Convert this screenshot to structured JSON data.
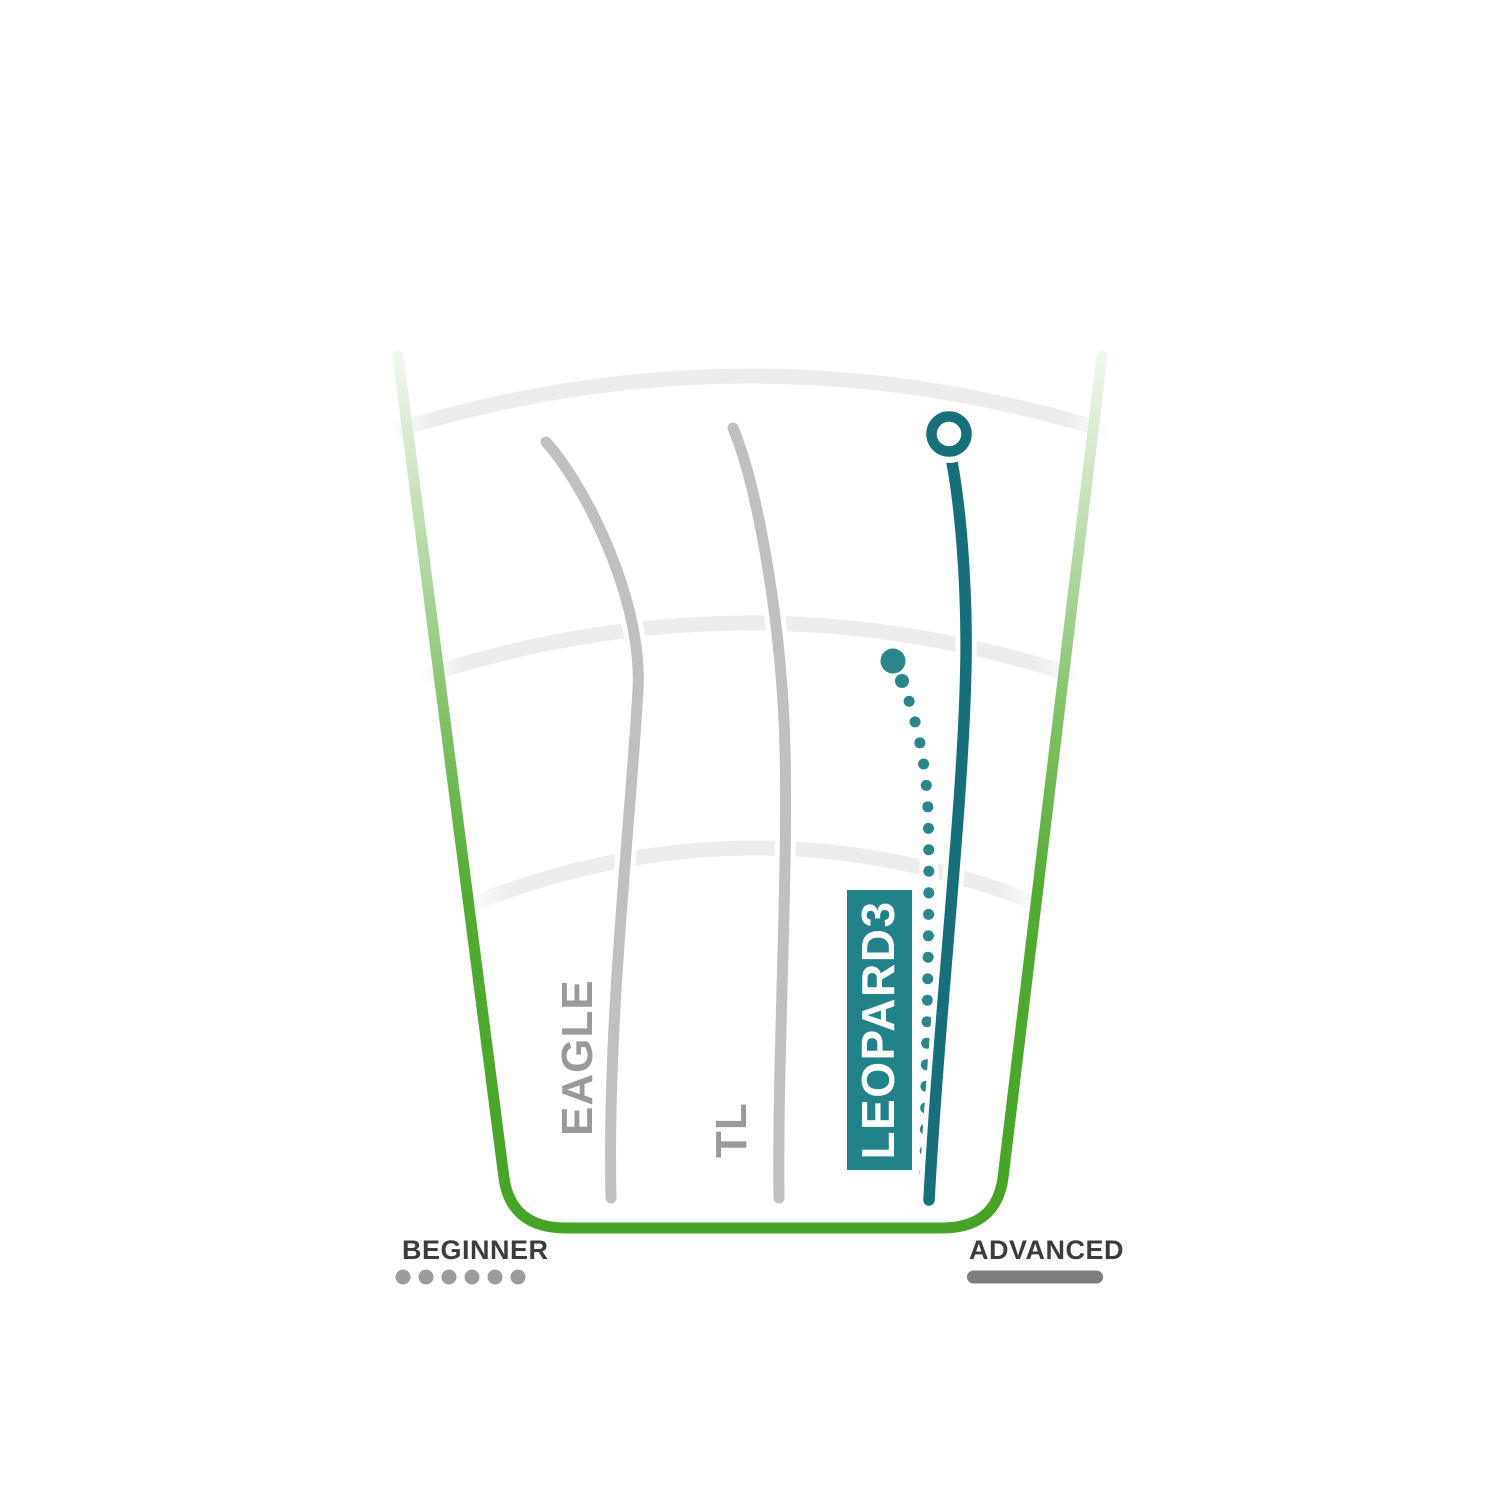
{
  "labels": {
    "beginner": "BEGINNER",
    "advanced": "ADVANCED"
  },
  "discs": {
    "eagle": "EAGLE",
    "tl": "TL",
    "leopard3": "LEOPARD3"
  },
  "colors": {
    "green": "#45a326",
    "green_mid": "#84c46a",
    "green_pale": "#cbe3c0",
    "green_faint": "#f2f6f0",
    "arc_gray": "#ededed",
    "gray_line": "#c0c0c0",
    "gray_text": "#9a9a9a",
    "teal_line": "#166f7a",
    "teal_box": "#21828a",
    "teal_dot": "#2b868c",
    "marker_fill": "#ffffff",
    "label_text_on_teal": "#ffffff",
    "legend_text": "#3c3c3c",
    "legend_dots": "#9c9c9c",
    "legend_bar": "#7d7d7d"
  },
  "chart_data": {
    "type": "line",
    "title": "Disc golf fairway driver flight path comparison",
    "xlabel": "player skill level (left = beginner, right = advanced)",
    "ylabel": "flight distance (3 unlabeled distance arcs as gridlines)",
    "legend_position": "bottom",
    "grid": "3 concentric light-gray distance arcs; green trapezoid border fading out toward the top",
    "axis_endpoints": [
      {
        "label": "BEGINNER",
        "marker_style": "6 gray dots"
      },
      {
        "label": "ADVANCED",
        "marker_style": "solid gray rounded bar"
      }
    ],
    "series": [
      {
        "name": "EAGLE",
        "style": "solid",
        "color": "#c0c0c0",
        "highlighted": false,
        "path_px": [
          [
            611,
            1198
          ],
          [
            620,
            930
          ],
          [
            638,
            690
          ],
          [
            600,
            520
          ],
          [
            546,
            442
          ]
        ]
      },
      {
        "name": "TL",
        "style": "solid",
        "color": "#c0c0c0",
        "highlighted": false,
        "path_px": [
          [
            779,
            1198
          ],
          [
            783,
            950
          ],
          [
            784,
            720
          ],
          [
            760,
            550
          ],
          [
            733,
            428
          ]
        ]
      },
      {
        "name": "LEOPARD3",
        "style": "solid",
        "color": "#166f7a",
        "highlighted": true,
        "end_marker": "open circle at top (landing point)",
        "path_px": [
          [
            929,
            1200
          ],
          [
            945,
            900
          ],
          [
            966,
            660
          ],
          [
            961,
            520
          ],
          [
            950,
            452
          ],
          [
            949,
            434
          ]
        ]
      },
      {
        "name": "LEOPARD3",
        "style": "dotted",
        "color": "#2b868c",
        "highlighted": true,
        "start_marker": "large filled dot",
        "path_px": [
          [
            893,
            661
          ],
          [
            902,
            681
          ],
          [
            920,
            740
          ],
          [
            928,
            810
          ],
          [
            928,
            1000
          ],
          [
            925,
            1192
          ]
        ]
      }
    ]
  }
}
